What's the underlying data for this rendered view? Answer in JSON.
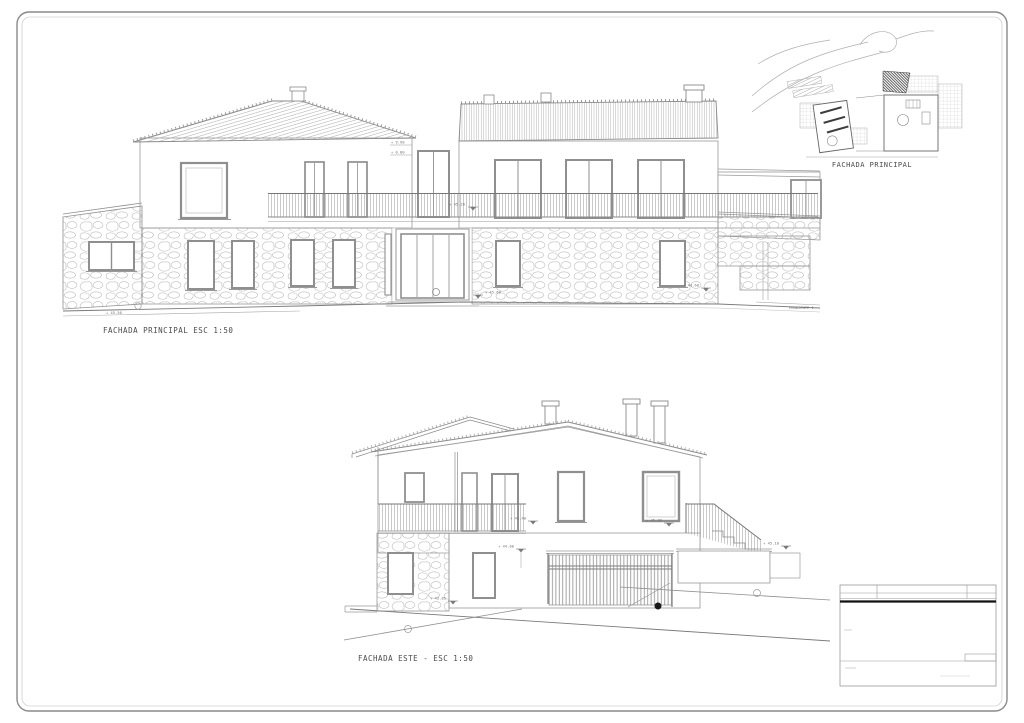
{
  "sheet": {
    "type_label": "architectural elevation sheet",
    "ink_color": "#7a7a7a",
    "frame_color": "#8a8a8a",
    "background": "#ffffff"
  },
  "principal": {
    "caption": "FACHADA PRINCIPAL ESC 1:50",
    "ground_level": "+ 45.50",
    "level_top": "+ 9.90",
    "level_mid": "+ 0.80",
    "spot_balcony": "+ 45.20",
    "spot_entrance": "+ 45.60",
    "spot_wall": "+ 44.60",
    "pendiente": "PENDIENTE 1"
  },
  "site_plan": {
    "caption": "FACHADA PRINCIPAL"
  },
  "este": {
    "caption": "FACHADA ESTE - ESC 1:50",
    "spot_balcony_left": "+ 45.40",
    "spot_balcony_right": "+ 45.80",
    "spot_garage": "+ 44.00",
    "spot_ground_left": "+ 43.85",
    "spot_terrace_right": "+ 45.10"
  }
}
